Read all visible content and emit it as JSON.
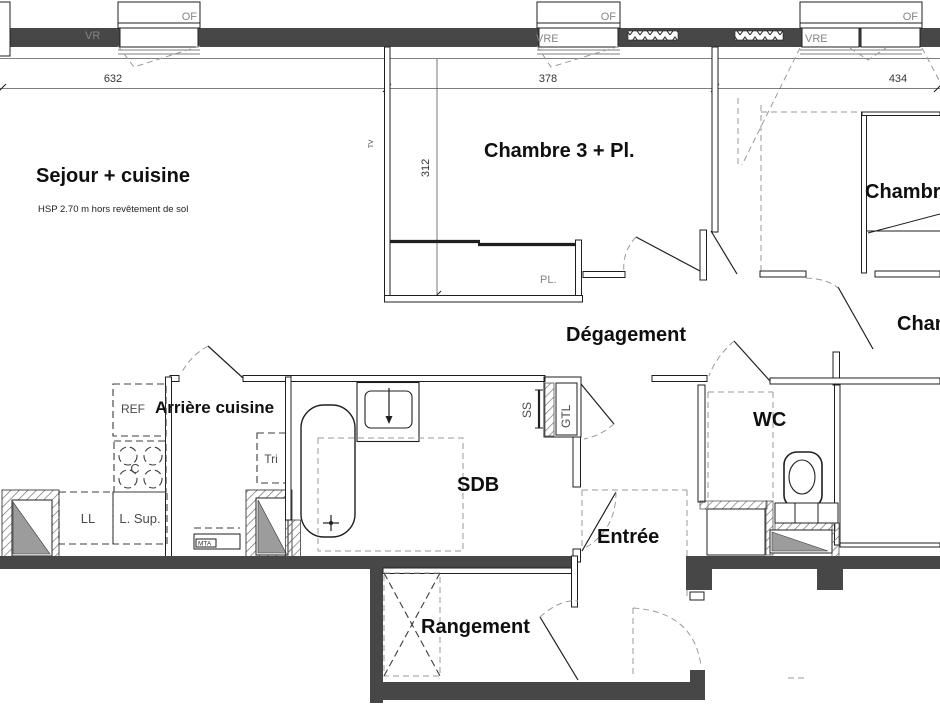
{
  "plan": {
    "rooms": {
      "sejour": {
        "label": "Sejour + cuisine",
        "note": "HSP 2.70 m hors revêtement de sol"
      },
      "chambre3": {
        "label": "Chambre 3 + Pl."
      },
      "chambre_est": {
        "label": "Chambre"
      },
      "chambre_sud_est": {
        "label": "Chambre"
      },
      "degagement": {
        "label": "Dégagement"
      },
      "arriere_cuisine": {
        "label": "Arrière cuisine"
      },
      "sdb": {
        "label": "SDB"
      },
      "wc": {
        "label": "WC"
      },
      "entree": {
        "label": "Entrée"
      },
      "rangement": {
        "label": "Rangement"
      }
    },
    "fixtures": {
      "placard": "PL.",
      "refrigerateur": "REF",
      "cuisiniere": "C",
      "tri": "Tri",
      "lave_linge": "LL",
      "lave_linge_sup": "L. Sup.",
      "seche_serviettes": "SS",
      "gaine_technique": "GTL",
      "mta": "MTA",
      "tv": "TV"
    },
    "windows": {
      "of": "OF",
      "vr": "VR",
      "vre": "VRE"
    },
    "dimensions": {
      "sejour_width": "632",
      "chambre3_width": "378",
      "chambre_width": "434",
      "chambre3_depth": "312"
    },
    "colors": {
      "wall": "#474747",
      "line": "#1f1f1f",
      "dash": "#9a9a9a",
      "gray_fill": "#9c9c9c"
    }
  }
}
